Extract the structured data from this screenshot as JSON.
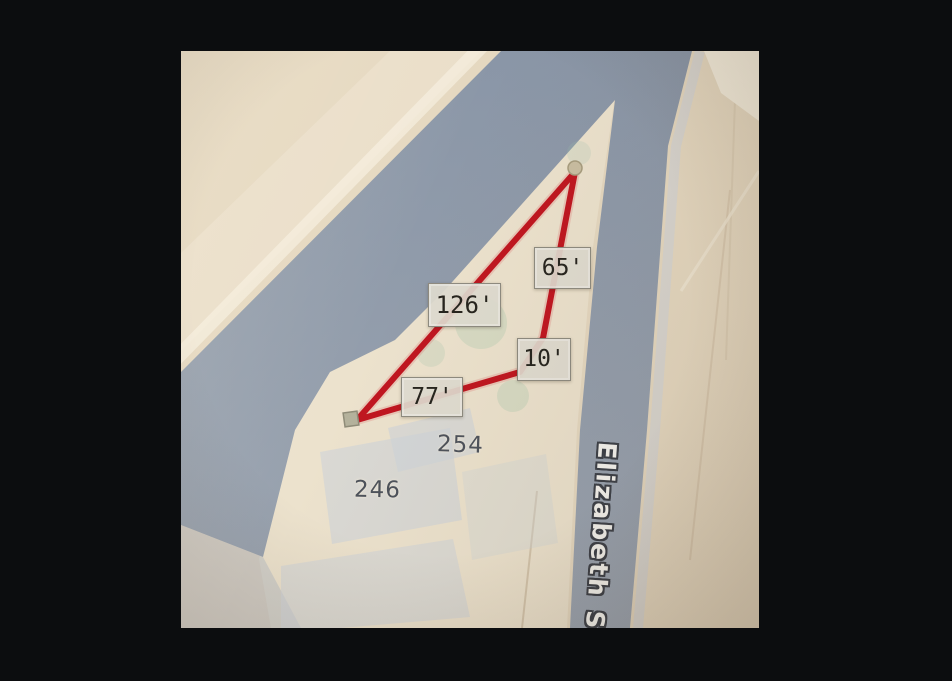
{
  "scene": {
    "description": "Photo of a parcel map with a red distance-measurement polygon",
    "frame_color": "#0c0d0f"
  },
  "map": {
    "street": {
      "label": "Elizabeth S"
    },
    "addresses": [
      {
        "label": "254"
      },
      {
        "label": "246"
      }
    ],
    "measurements": [
      {
        "label": "65'"
      },
      {
        "label": "126'"
      },
      {
        "label": "10'"
      },
      {
        "label": "77'"
      }
    ],
    "colors": {
      "land": "#e5d8c0",
      "parcel_wedge": "#ece2cd",
      "road": "#95a0ae",
      "measure_line": "#c01620",
      "label_bg": "#dfdbd0",
      "label_border": "#8e8b80",
      "label_text": "#26241e",
      "street_text": "#f5f4ef",
      "street_outline": "#3b3f47",
      "address_text": "#4d525b",
      "building": "#cfd3d8"
    }
  }
}
